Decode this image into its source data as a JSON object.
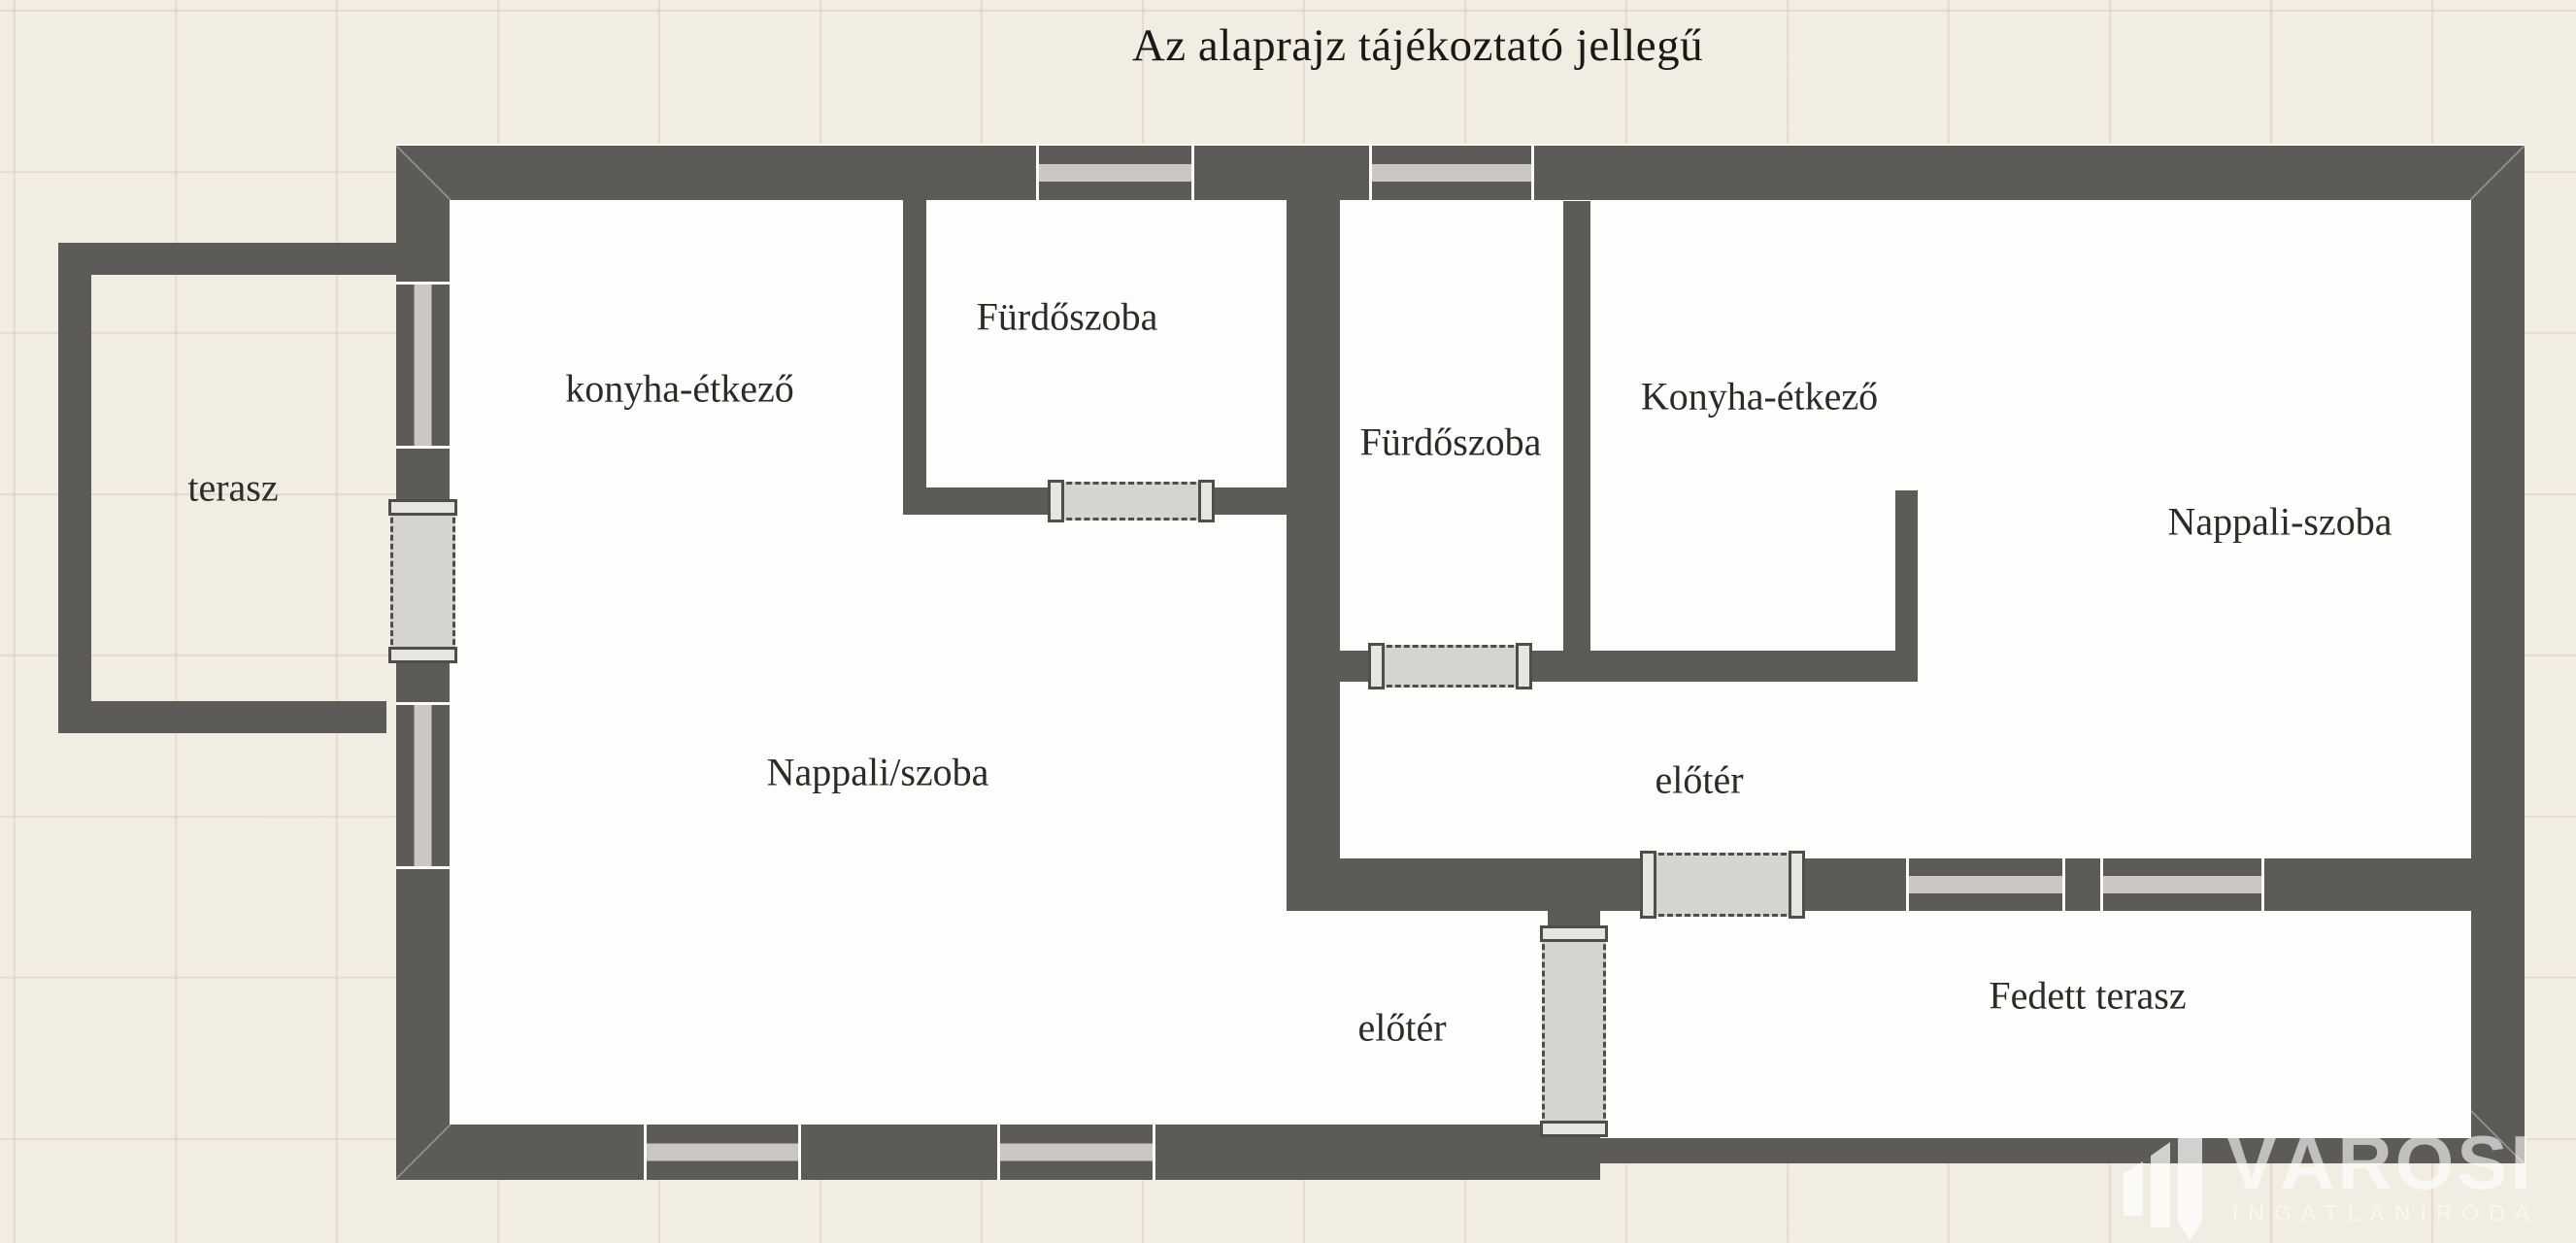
{
  "title": "Az alaprajz tájékoztató jellegű",
  "rooms": {
    "terasz": {
      "label": "terasz"
    },
    "konyha_etkezo_bal": {
      "label": "konyha-étkező"
    },
    "furdoszoba_bal": {
      "label": "Fürdőszoba"
    },
    "nappali_szoba_bal": {
      "label": "Nappali/szoba"
    },
    "eloter_bal": {
      "label": "előtér"
    },
    "furdoszoba_jobb": {
      "label": "Fürdőszoba"
    },
    "konyha_etkezo_jobb": {
      "label": "Konyha-étkező"
    },
    "nappali_szoba_jobb": {
      "label": "Nappali-szoba"
    },
    "eloter_jobb": {
      "label": "előtér"
    },
    "fedett_terasz": {
      "label": "Fedett terasz"
    }
  },
  "watermark": {
    "brand": "VÁROSI",
    "tagline": "INGATLANIRODA"
  },
  "colors": {
    "wall": "#5d5b58",
    "floor": "#fdfdfc",
    "background": "#f2ede2",
    "window": "#cbc8c4",
    "door": "#d6d4d0"
  }
}
